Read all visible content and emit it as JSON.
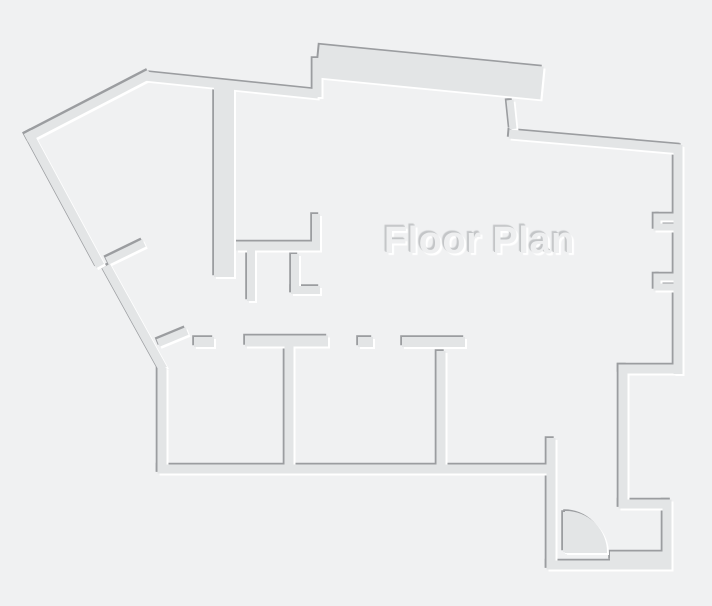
{
  "title": "Floor Plan",
  "colors": {
    "background": "#f0f1f2",
    "wall_fill": "#e3e5e6",
    "shadow_dark": "#9b9da0",
    "highlight_white": "#ffffff",
    "title_fill": "#eeeff0",
    "title_shadow_dark": "#c3c5c7",
    "title_shadow_light": "#ffffff"
  },
  "floorplan": {
    "canvas": {
      "width": 712,
      "height": 606
    },
    "default_wall_thickness": 9,
    "emboss": {
      "dark_offset": -1.8,
      "light_offset": 2
    },
    "walls": [
      [
        30,
        136,
        146,
        76,
        9,
        "square"
      ],
      [
        30,
        136,
        98,
        262,
        9,
        "square"
      ],
      [
        144,
        76,
        318,
        94,
        9
      ],
      [
        317,
        97,
        317,
        58,
        9
      ],
      [
        318,
        61,
        542,
        83,
        33
      ],
      [
        510,
        100,
        513,
        129,
        7
      ],
      [
        509,
        134,
        681,
        149,
        9
      ],
      [
        678,
        145,
        678,
        374,
        9
      ],
      [
        657,
        217,
        676,
        217,
        7
      ],
      [
        657,
        213.5,
        657,
        230.5,
        7
      ],
      [
        657,
        227,
        676,
        227,
        7
      ],
      [
        657,
        277,
        676,
        277,
        7
      ],
      [
        657,
        273.5,
        657,
        290.5,
        7
      ],
      [
        657,
        287,
        676,
        287,
        7
      ],
      [
        618.5,
        369,
        682.5,
        369,
        9
      ],
      [
        623,
        364.5,
        623,
        508.5,
        9
      ],
      [
        618.5,
        504,
        671.5,
        504,
        9
      ],
      [
        667,
        499.5,
        667,
        569.5,
        9
      ],
      [
        546.5,
        565,
        671.5,
        565,
        9
      ],
      [
        610,
        556,
        671,
        556,
        9
      ],
      [
        551,
        438,
        551,
        569.5,
        9
      ],
      [
        157.5,
        469,
        555.5,
        469,
        9
      ],
      [
        162,
        368,
        162,
        473.5,
        9
      ],
      [
        106,
        266,
        163,
        369,
        9
      ],
      [
        107,
        261,
        144,
        243,
        8
      ],
      [
        224,
        86,
        224,
        277,
        20
      ],
      [
        236,
        246,
        320,
        246,
        9
      ],
      [
        316,
        248,
        316,
        214,
        8
      ],
      [
        251,
        248,
        251,
        301,
        8
      ],
      [
        295,
        254,
        295,
        294,
        8
      ],
      [
        291,
        290,
        320,
        290,
        8
      ],
      [
        194,
        342,
        214,
        342,
        10
      ],
      [
        158,
        343,
        187,
        331,
        8
      ],
      [
        245,
        341,
        328,
        341,
        11
      ],
      [
        289,
        345,
        289,
        471,
        9
      ],
      [
        358,
        342,
        373,
        342,
        10
      ],
      [
        402,
        342,
        465,
        342,
        10
      ],
      [
        441,
        351,
        441,
        471,
        9
      ],
      [
        566,
        512,
        566,
        552,
        6
      ]
    ],
    "door": {
      "swing_path": "M 566,552 L 566,512 A 40 40 0 0 1 606,552 Z"
    }
  }
}
